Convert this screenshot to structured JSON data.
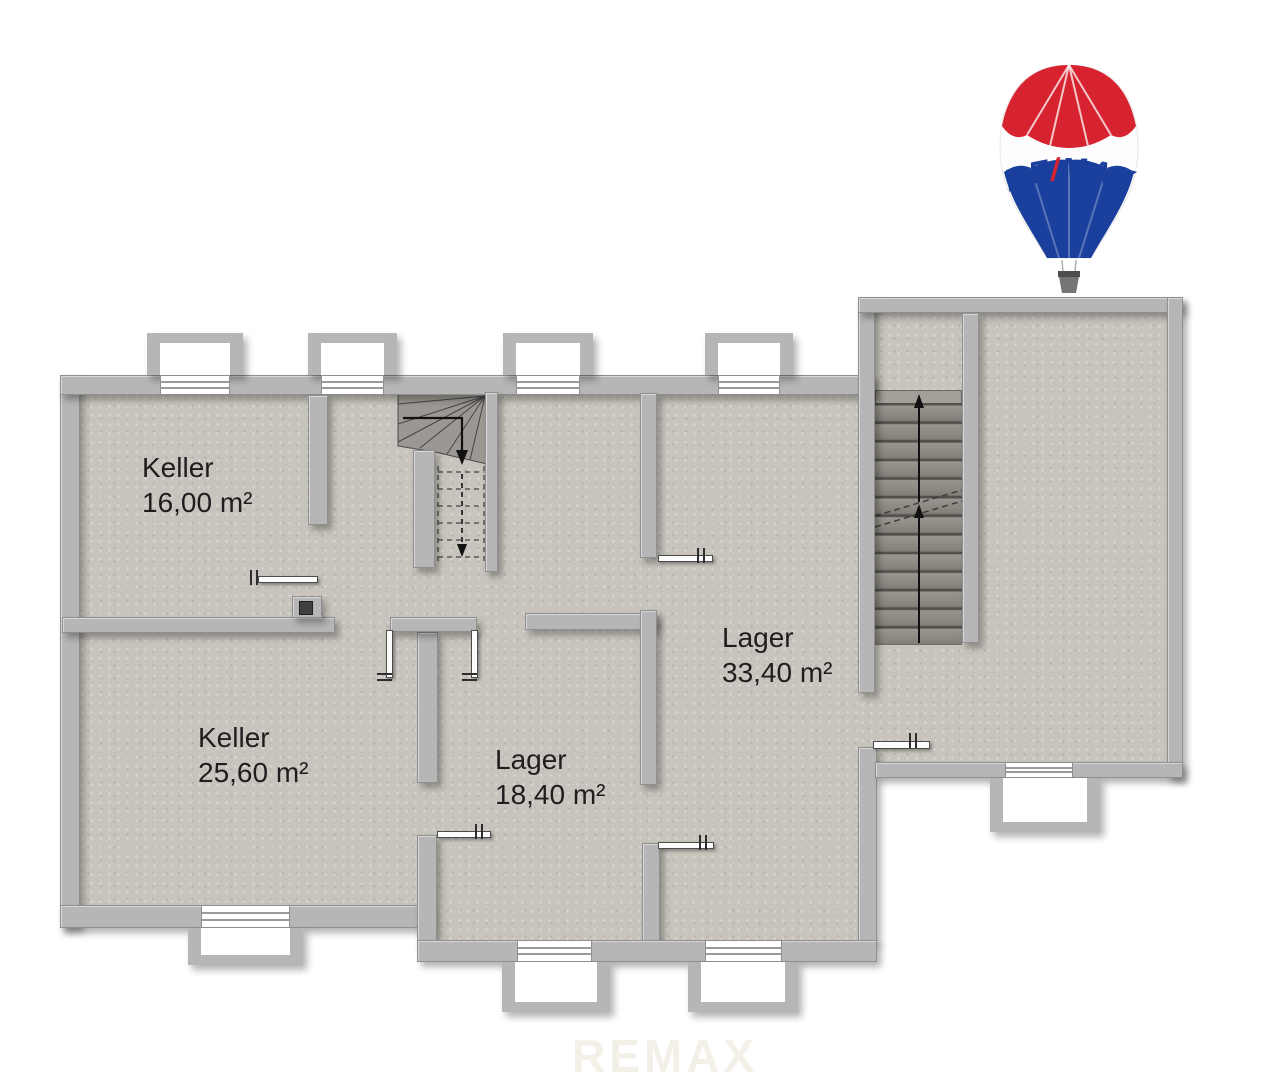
{
  "branding": {
    "logo": {
      "re": "RE",
      "slash": "/",
      "max": "MAX",
      "balloon_icon": "remax-hot-air-balloon",
      "red": "#d7222f",
      "blue": "#1a3f9c"
    },
    "watermark": "REMAX"
  },
  "floorplan": {
    "rooms": [
      {
        "name": "Keller",
        "area": "16,00 m²"
      },
      {
        "name": "Keller",
        "area": "25,60 m²"
      },
      {
        "name": "Lager",
        "area": "18,40 m²"
      },
      {
        "name": "Lager",
        "area": "33,40 m²"
      }
    ],
    "stairs": [
      {
        "type": "winder",
        "direction": "down"
      },
      {
        "type": "straight",
        "direction": "up"
      }
    ],
    "palette": {
      "wall": "#b6b6b6",
      "floor": "#c8c4bd",
      "outline": "#8f8f8f"
    }
  }
}
